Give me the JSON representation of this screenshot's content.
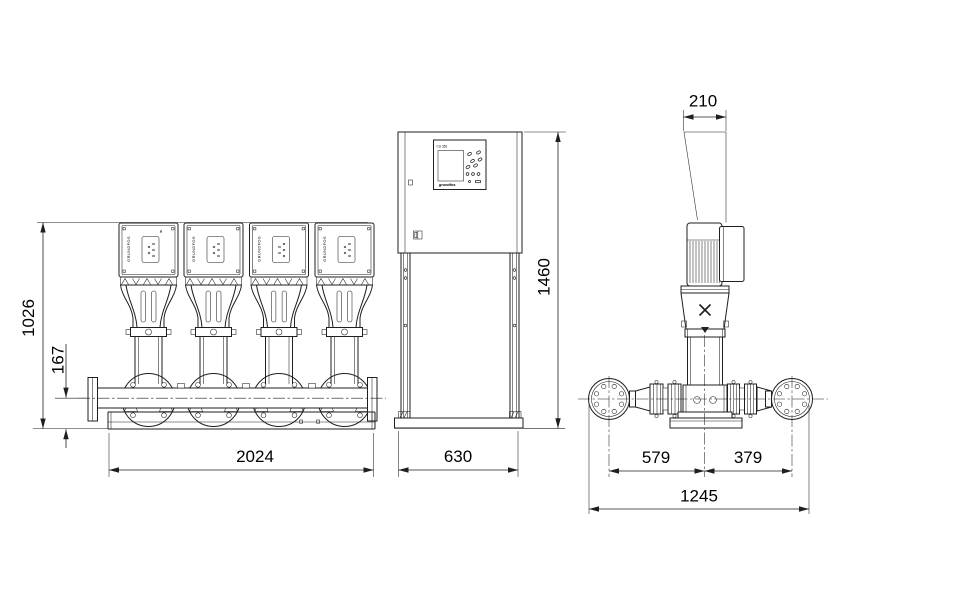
{
  "dimensions": {
    "front_height": "1026",
    "manifold_center_height": "167",
    "front_length": "2024",
    "cabinet_width": "630",
    "cabinet_height": "1460",
    "motor_clearance": "210",
    "suction_offset": "579",
    "discharge_offset": "379",
    "overall_depth": "1245"
  },
  "labels": {
    "controller": "CU 352",
    "brand": "grundfos",
    "pump_side_text": "GRUNDFOS"
  },
  "colors": {
    "line": "#1f1f1f",
    "background": "#ffffff"
  }
}
